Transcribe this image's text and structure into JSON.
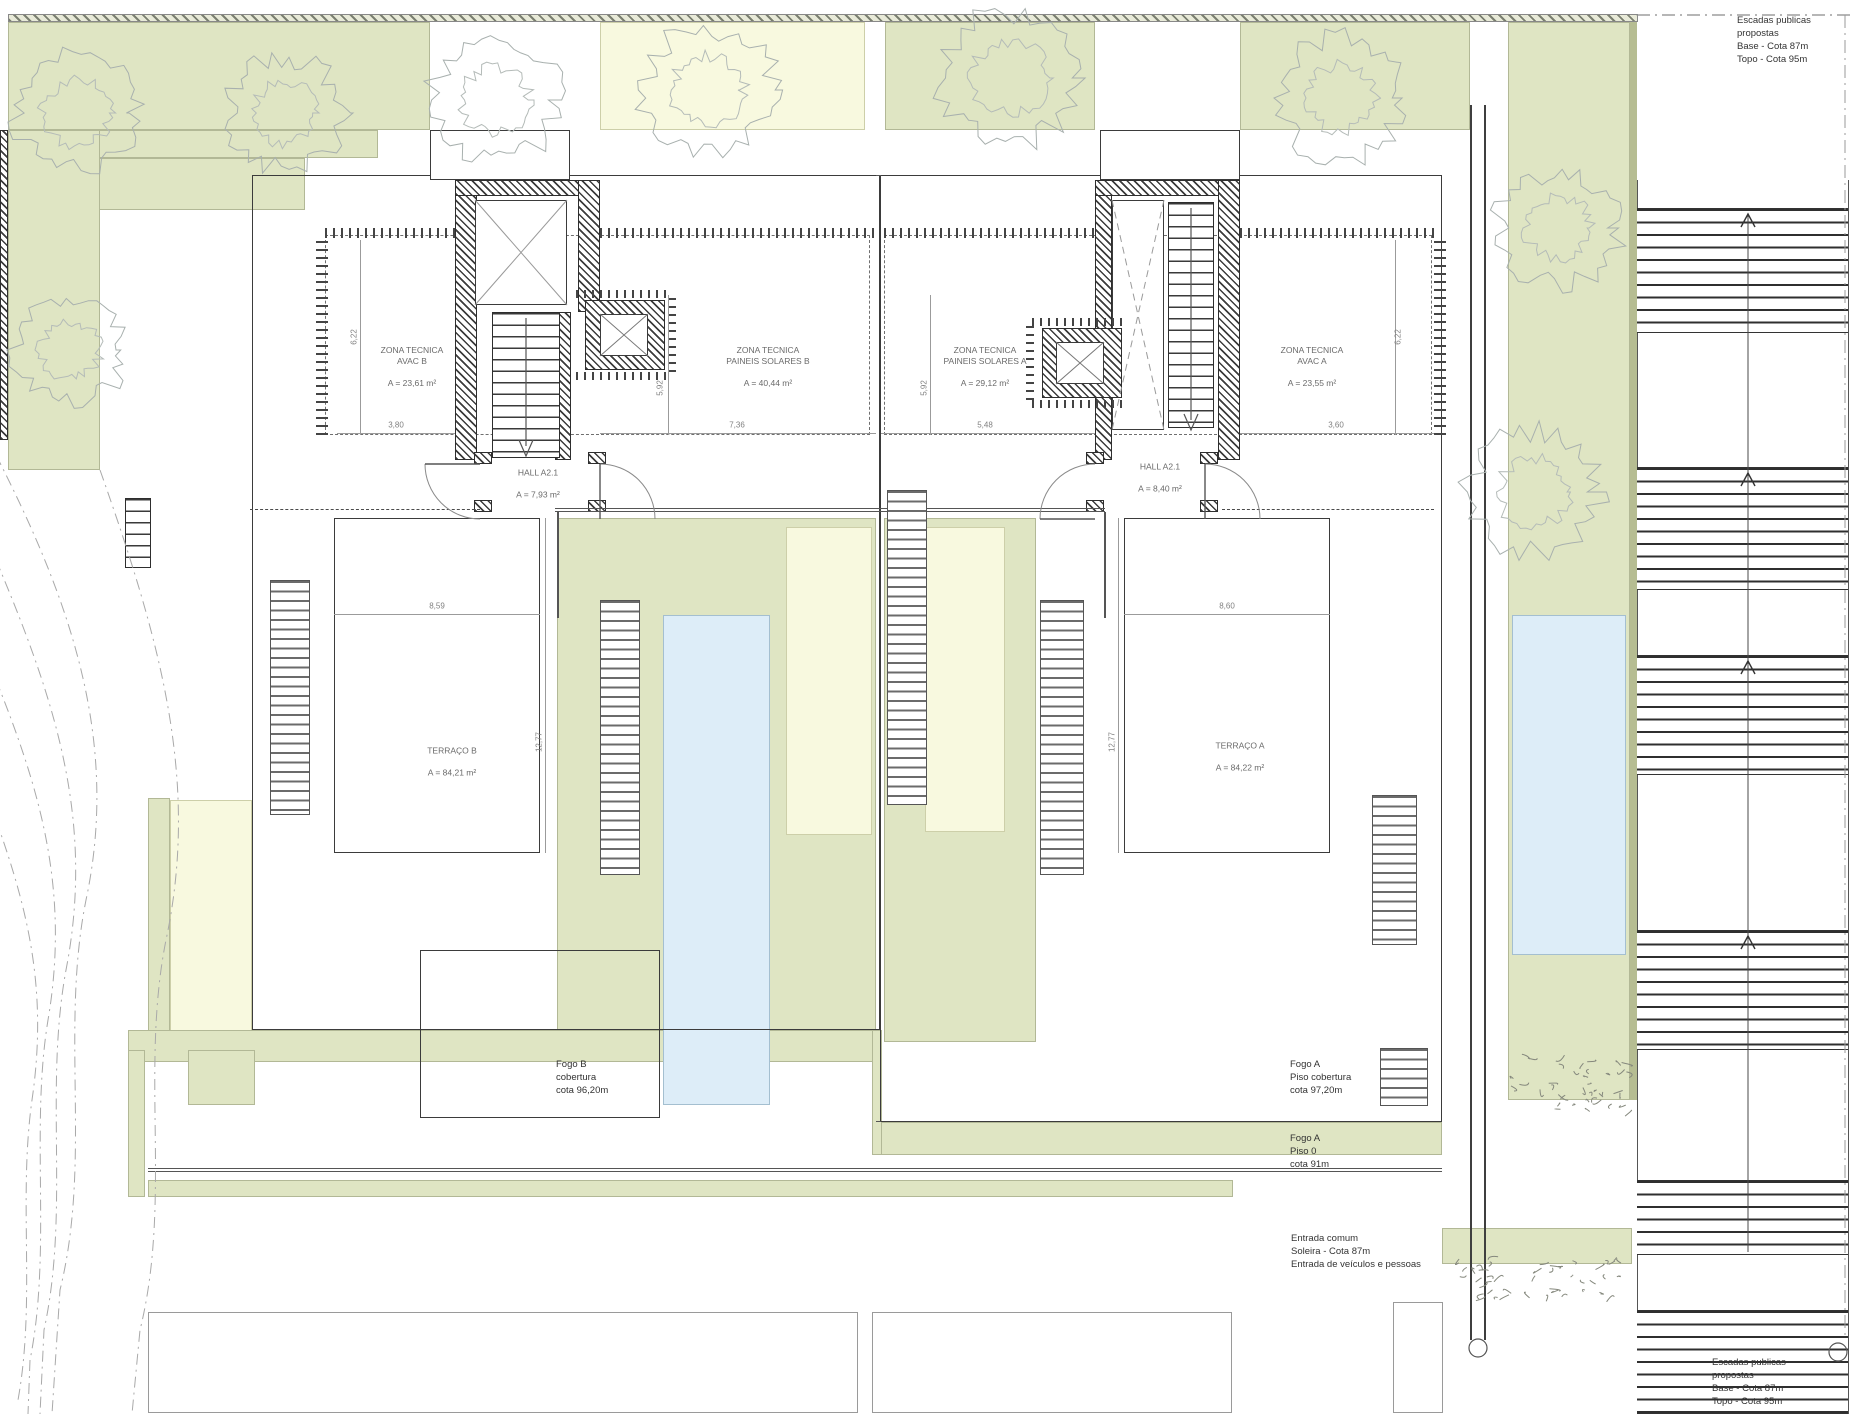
{
  "rooms": {
    "avac_b": {
      "name": "ZONA TECNICA\nAVAC B",
      "area": "A = 23,61 m²"
    },
    "solar_b": {
      "name": "ZONA TECNICA\nPAINEIS SOLARES B",
      "area": "A = 40,44 m²"
    },
    "solar_a": {
      "name": "ZONA TECNICA\nPAINEIS SOLARES A",
      "area": "A = 29,12 m²"
    },
    "avac_a": {
      "name": "ZONA TECNICA\nAVAC A",
      "area": "A = 23,55 m²"
    },
    "hall_b": {
      "name": "HALL A2.1",
      "area": "A = 7,93 m²"
    },
    "hall_a": {
      "name": "HALL A2.1",
      "area": "A = 8,40 m²"
    },
    "terraco_b": {
      "name": "TERRAÇO B",
      "area": "A = 84,21 m²"
    },
    "terraco_a": {
      "name": "TERRAÇO A",
      "area": "A = 84,22 m²"
    }
  },
  "notes": {
    "fogo_b": "Fogo B\ncobertura\ncota 96,20m",
    "fogo_a_cobertura": "Fogo A\nPiso cobertura\ncota 97,20m",
    "fogo_a_piso0": "Fogo A\nPiso 0\ncota 91m",
    "entrada": "Entrada comum\nSoleira - Cota 87m\nEntrada de veículos e pessoas",
    "escadas_top": "Escadas publicas\npropostas\nBase - Cota 87m\nTopo - Cota 95m",
    "escadas_bottom": "Escadas publicas\npropostas\nBase - Cota 87m\nTopo - Cota 95m"
  },
  "dimensions": {
    "d_3_80": "3,80",
    "d_7_36": "7,36",
    "d_5_48": "5,48",
    "d_3_60": "3,60",
    "d_6_22": "6,22",
    "d_5_92": "5,92",
    "d_8_59": "8,59",
    "d_8_60": "8,60",
    "d_12_77": "12,77"
  },
  "colors": {
    "garden_green": "#dfe5c3",
    "pale_yellow": "#f8f9df",
    "pool_blue": "#ddedf8",
    "wall_hatch": "#3c3c3c",
    "outline": "#3b3b3b",
    "dim_gray": "#808080"
  }
}
